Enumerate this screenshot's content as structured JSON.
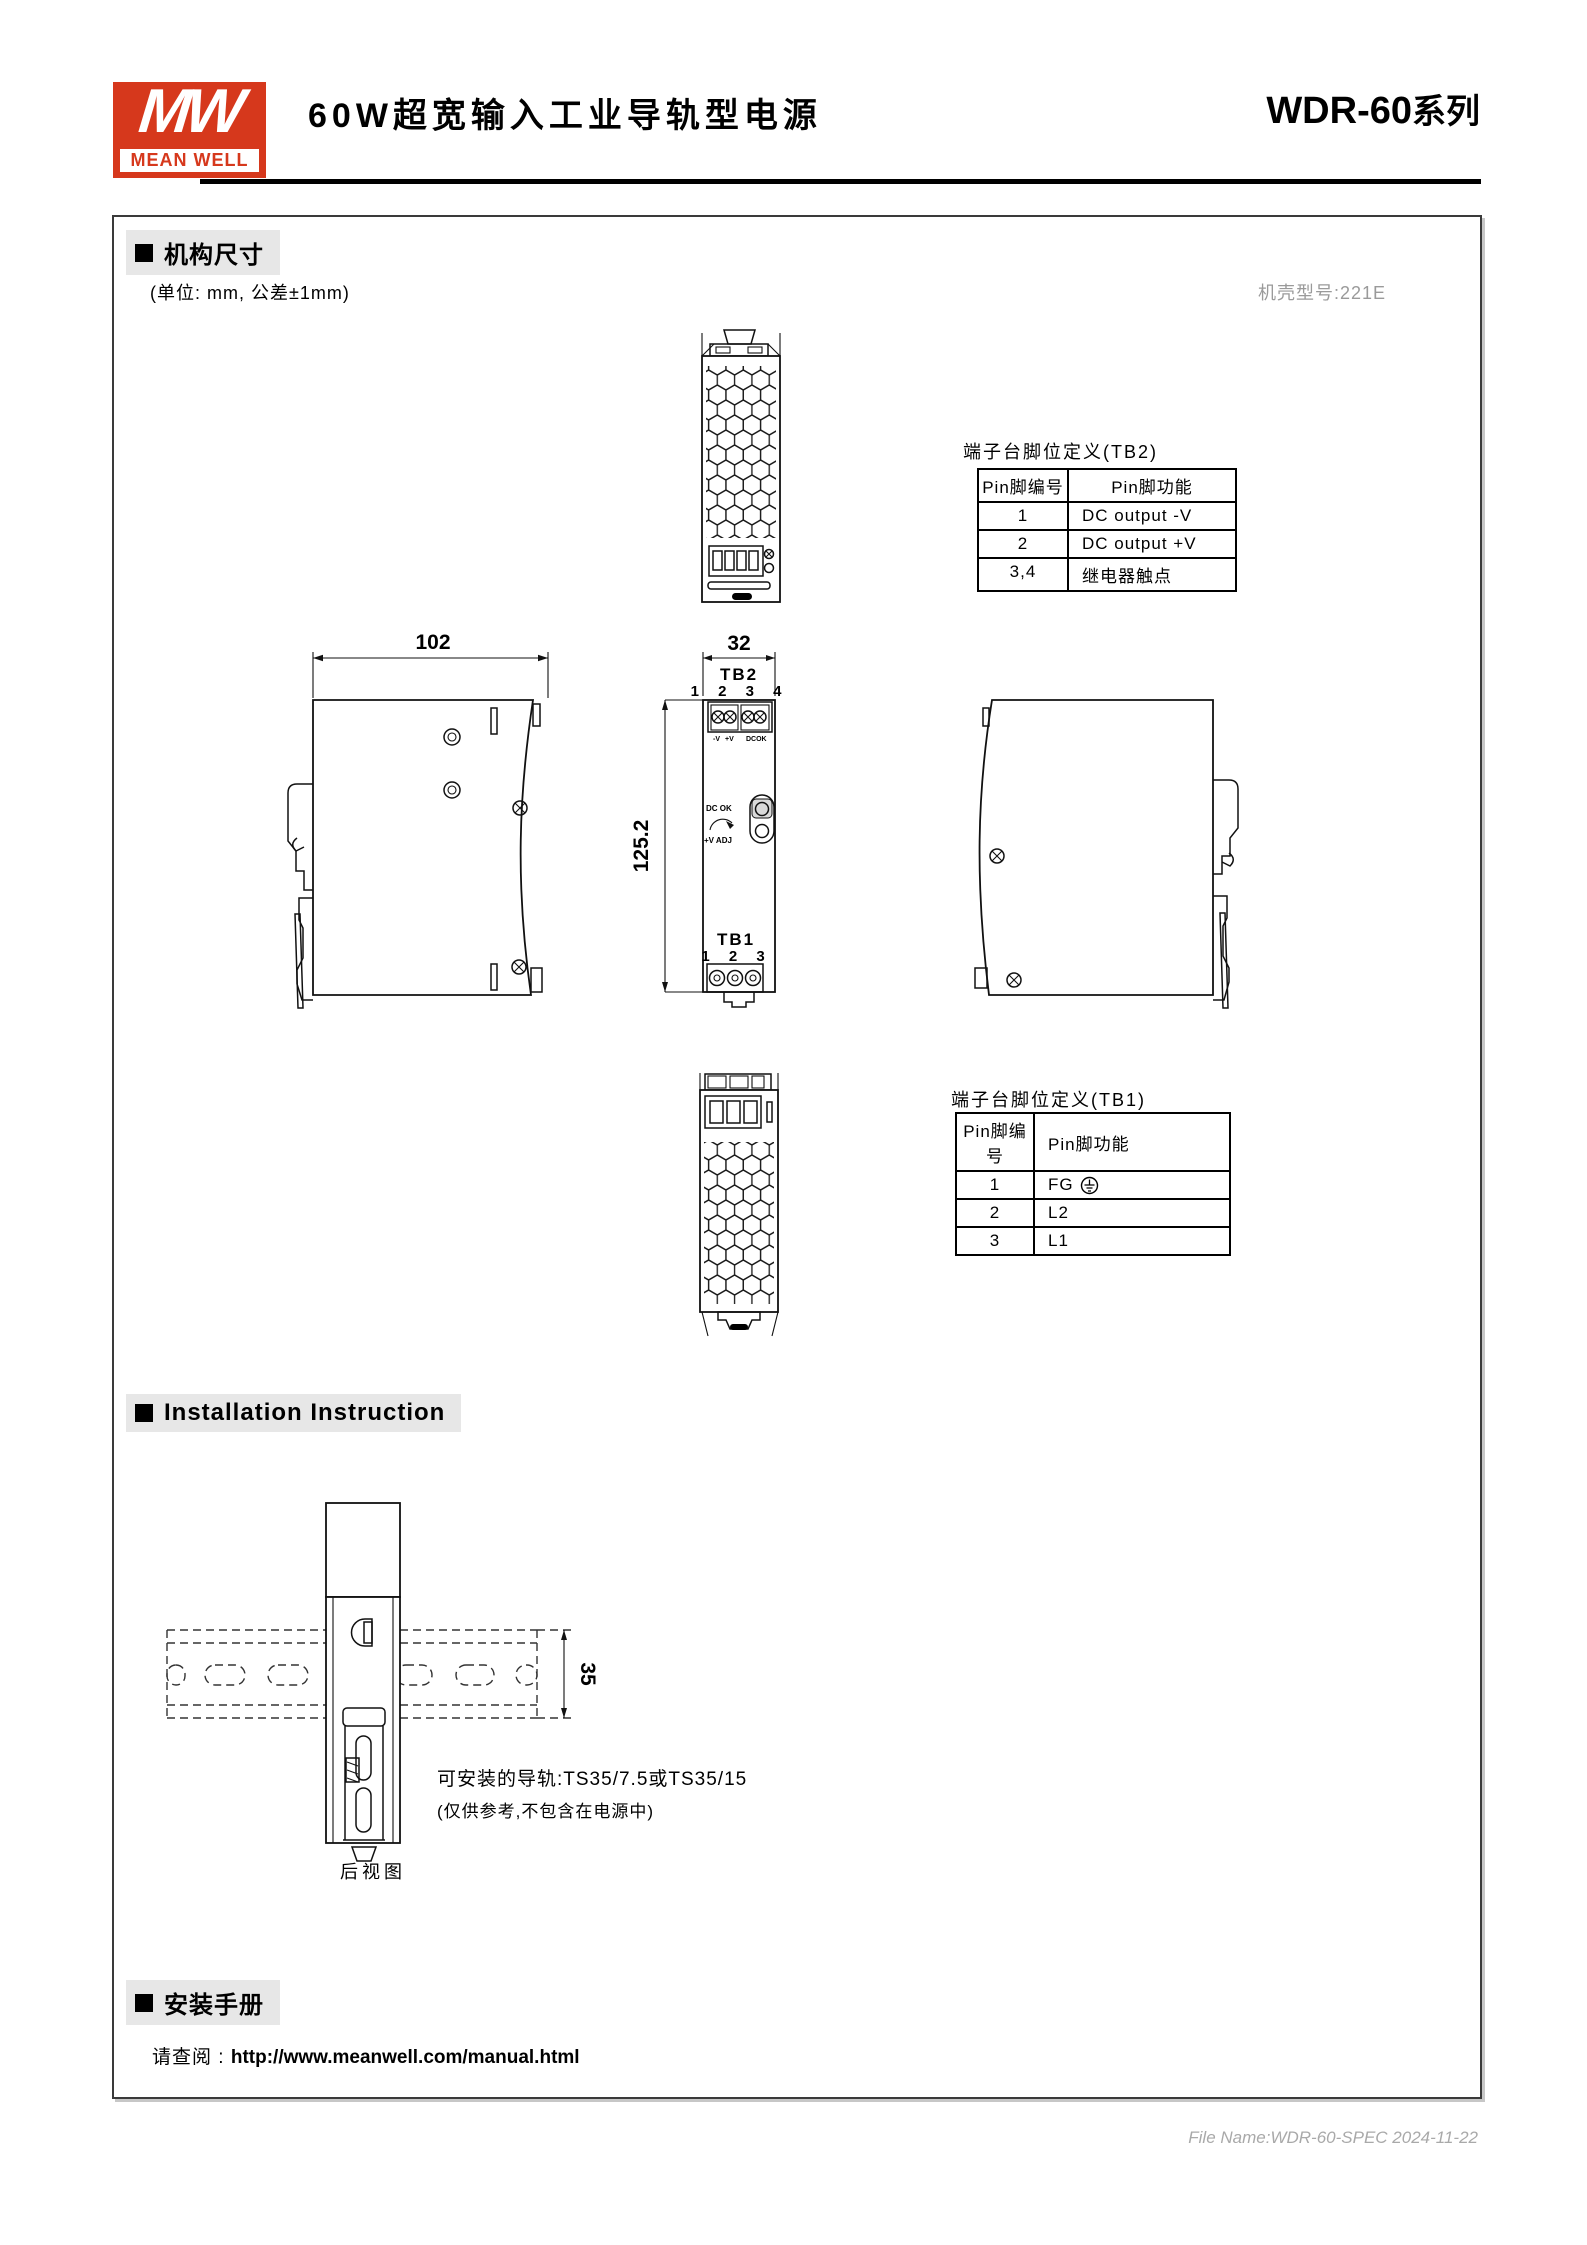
{
  "header": {
    "logo_mw": "MW",
    "logo_brand": "MEAN WELL",
    "title": "60W超宽输入工业导轨型电源",
    "series_bold": "WDR-60",
    "series_cn": "系列"
  },
  "mech": {
    "title": "机构尺寸",
    "unit_note": "(单位: mm, 公差±1mm)",
    "case_note": "机壳型号:221E"
  },
  "tb2": {
    "title": "端子台脚位定义(TB2)",
    "col1": "Pin脚编号",
    "col2": "Pin脚功能",
    "rows": [
      {
        "pin": "1",
        "fn": "DC output  -V"
      },
      {
        "pin": "2",
        "fn": "DC output  +V"
      },
      {
        "pin": "3,4",
        "fn": "继电器触点"
      }
    ]
  },
  "tb1": {
    "title": "端子台脚位定义(TB1)",
    "col1": "Pin脚编号",
    "col2": "Pin脚功能",
    "rows": [
      {
        "pin": "1",
        "fn": "FG"
      },
      {
        "pin": "2",
        "fn": "L2"
      },
      {
        "pin": "3",
        "fn": "L1"
      }
    ]
  },
  "dims": {
    "width": "102",
    "front_width": "32",
    "height": "125.2",
    "rail": "35"
  },
  "front": {
    "tb2": "TB2",
    "tb2_pins": "1 2 3 4",
    "neg": "-V",
    "pos": "+V",
    "dcok": "DCOK",
    "dc_ok": "DC OK",
    "v_adj": "+V ADJ",
    "tb1": "TB1",
    "tb1_pins": "1 2 3"
  },
  "install": {
    "title": "Installation Instruction",
    "note1": "可安装的导轨:TS35/7.5或TS35/15",
    "note2": "(仅供参考,不包含在电源中)",
    "rear": "后视图"
  },
  "manual": {
    "title": "安装手册",
    "prefix": "请查阅 :",
    "url": "http://www.meanwell.com/manual.html"
  },
  "footer": {
    "file": "File Name:WDR-60-SPEC  2024-11-22"
  }
}
